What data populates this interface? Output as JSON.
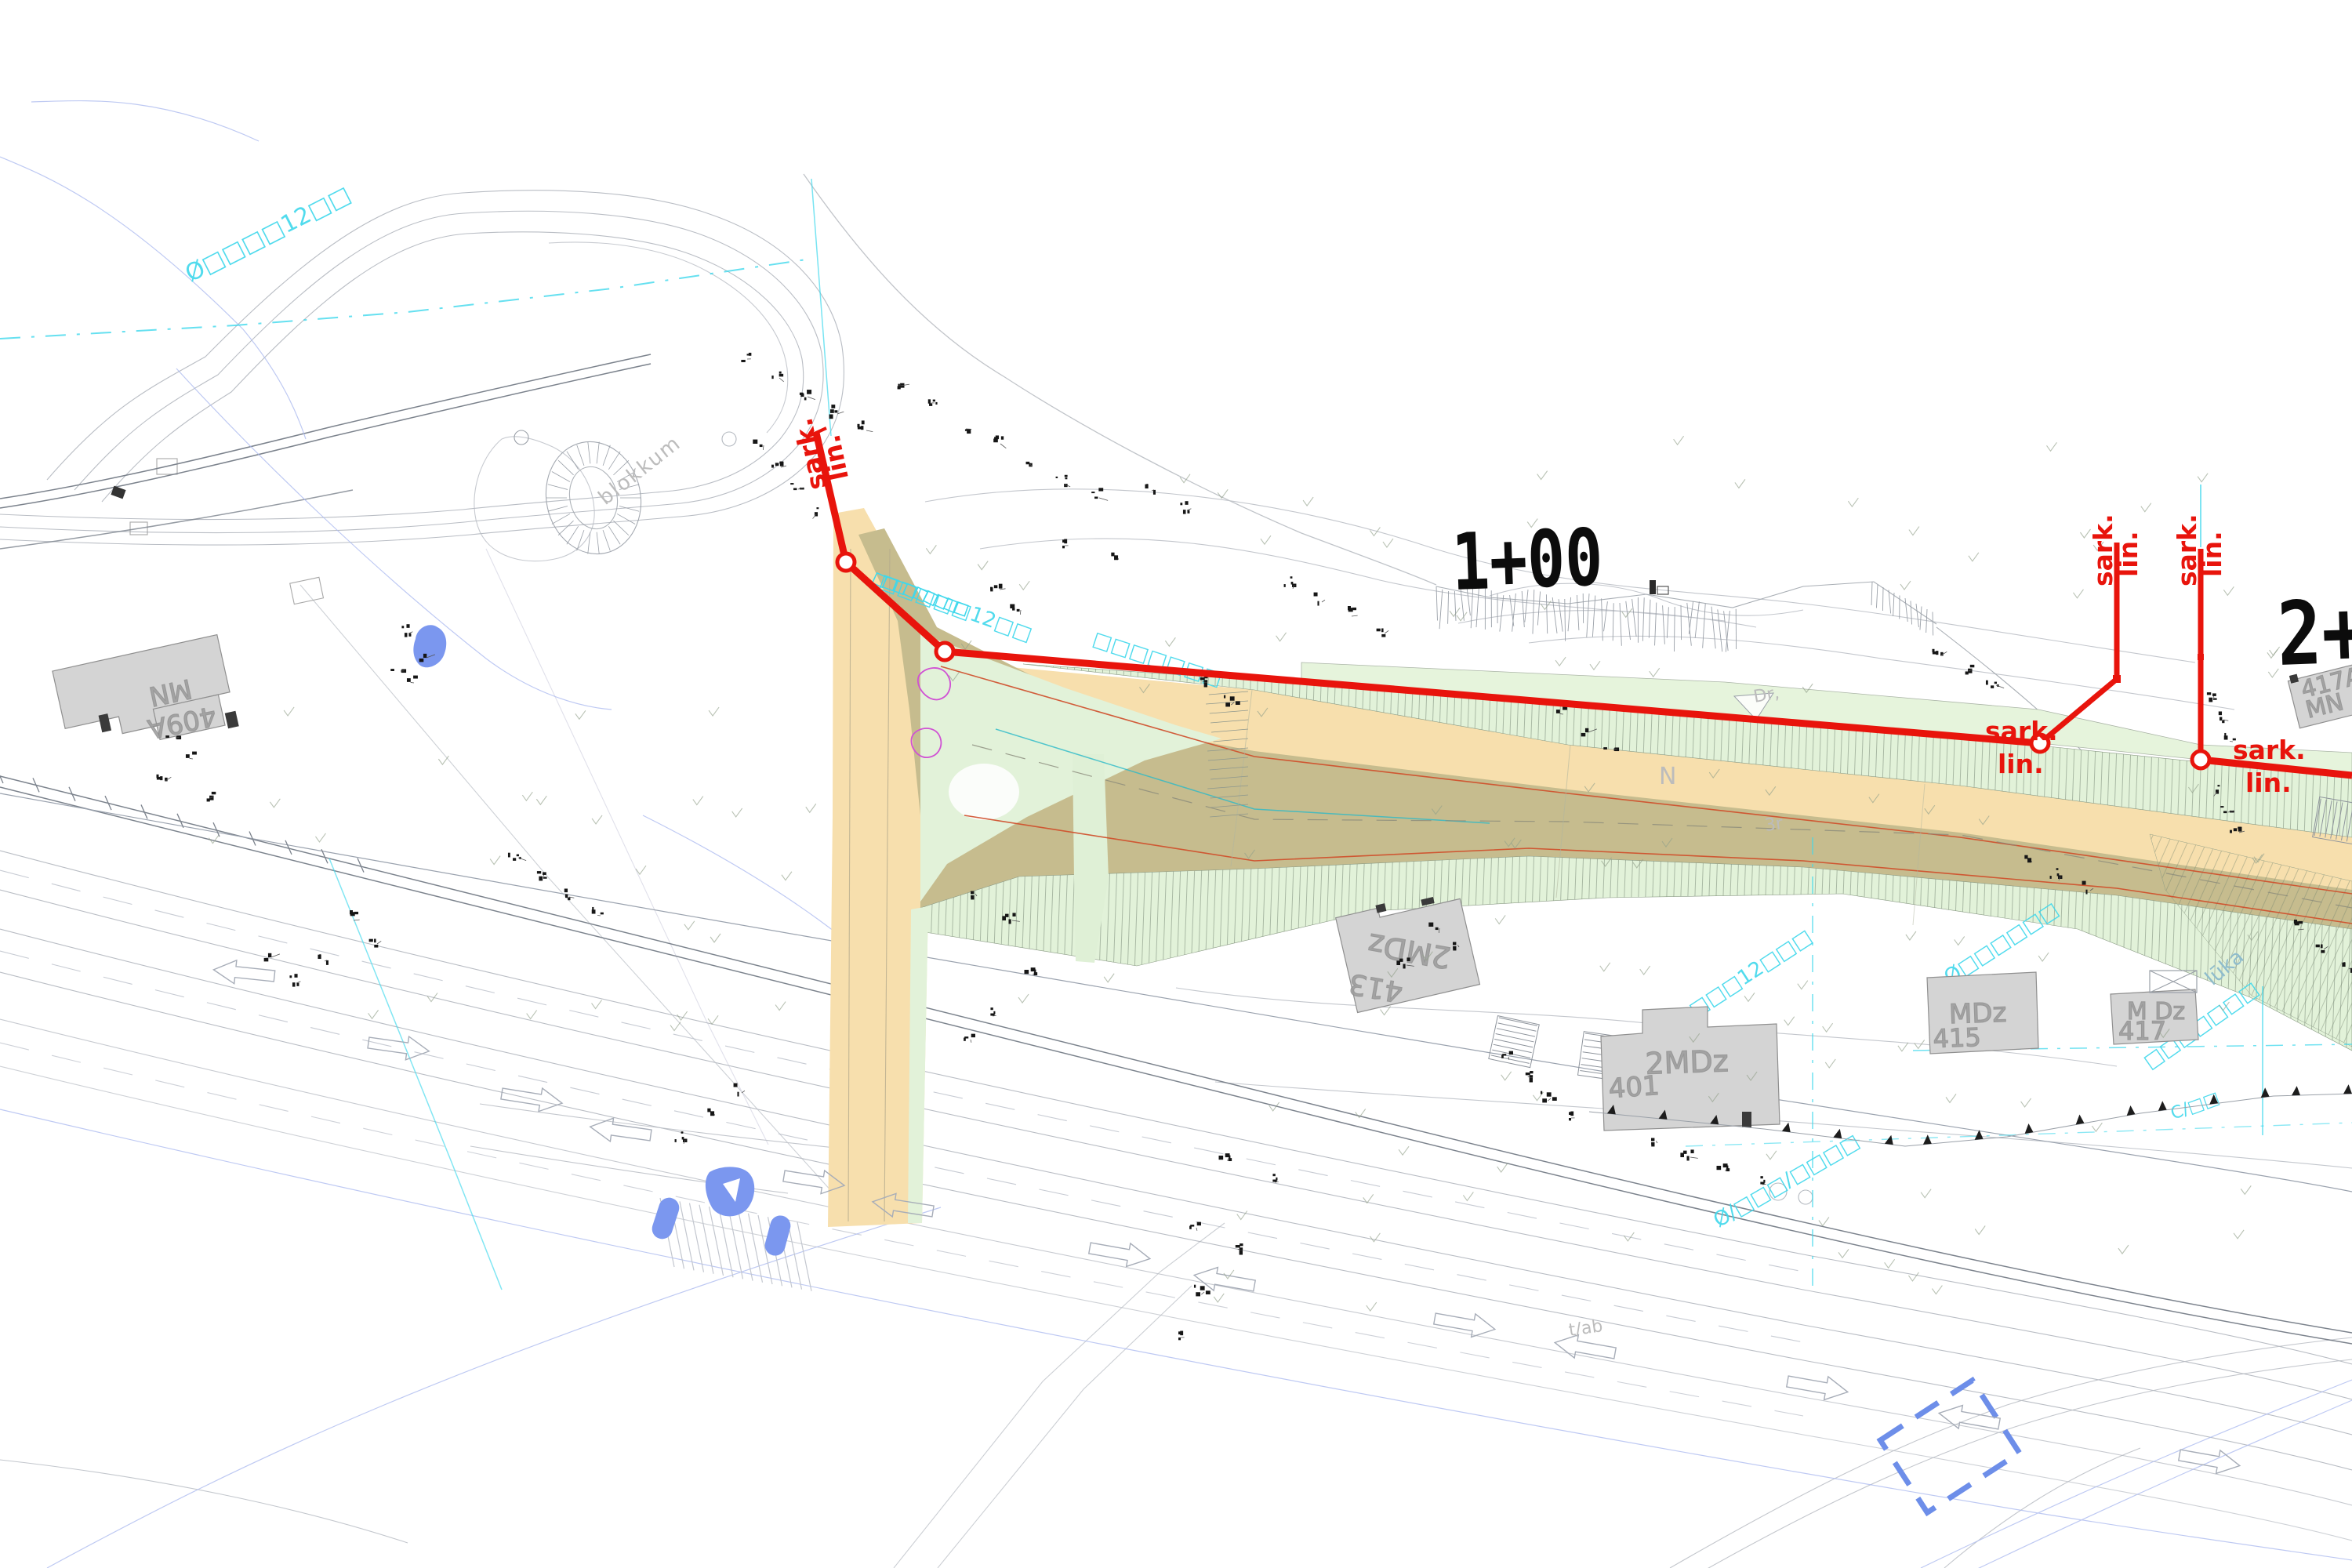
{
  "page": {
    "type": "civil-site-plan"
  },
  "stations": {
    "s1": "1+00",
    "s2": "2+"
  },
  "alignment": {
    "markers": [
      {
        "l1": "sark.",
        "l2": "lin."
      },
      {
        "l1": "sark.",
        "l2": "lin."
      },
      {
        "l1": "sark.",
        "l2": "lin."
      },
      {
        "l1": "sark.",
        "l2": "lin."
      },
      {
        "l1": "sark.",
        "l2": "lin."
      }
    ]
  },
  "buildings": {
    "b409a": {
      "l1": "MN",
      "l2": "409A"
    },
    "b413": {
      "no": "413",
      "type": "2MDz"
    },
    "b401": {
      "no": "401",
      "type": "2MDz"
    },
    "b415": {
      "no": "415",
      "type": "MDz"
    },
    "b417": {
      "no": "417",
      "type": "M Dz"
    },
    "b417a": {
      "no": "417A",
      "type": "MN"
    }
  },
  "annotations": {
    "north": "N",
    "dr": "Dr,",
    "r3": "3r",
    "tab": "t/ab",
    "blokkum": "blokkum",
    "luka": "lūka"
  },
  "utilities": {
    "u1": "Ø□□□□12□□",
    "u2": "□□□□□12□□",
    "u3": "Ø□□□□12□□□",
    "u4": "Ø□□□□□□",
    "u5": "Ø/□□□/□□□□",
    "u6": "□□□□□□□",
    "u7": "C/□□"
  },
  "colors": {
    "red": "#e8140c",
    "thin_red": "#cf4b28",
    "teal_line": "#2ab9c8",
    "tan": "#f7dfad",
    "olive": "#c6bc8e",
    "mint": "#e2f2d9",
    "green_strip": "#e6f4dc",
    "cyan": "#3fd8ec",
    "blue": "#7b97ef",
    "blue_dash": "#6d8ee9",
    "magenta": "#d051d4",
    "gray_line": "#b9bdc4",
    "building_gray": "#d4d4d4"
  }
}
